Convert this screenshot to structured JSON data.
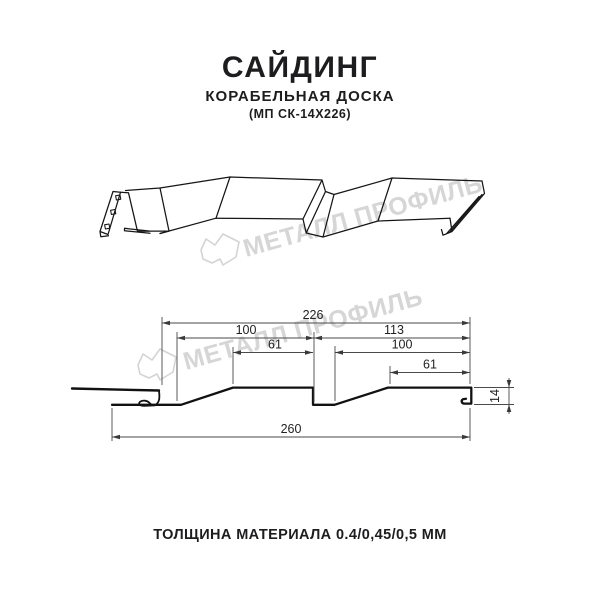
{
  "header": {
    "title": "САЙДИНГ",
    "subtitle": "КОРАБЕЛЬНАЯ ДОСКА",
    "model": "(МП СК-14Х226)"
  },
  "watermark": {
    "brand": "МЕТАЛЛ ПРОФИЛЬ",
    "color": "#d6d6d6"
  },
  "dimensions": {
    "overall_top": "226",
    "left_upper": "100",
    "right_upper": "113",
    "left_inner": "61",
    "right_inner": "100",
    "right_lower": "61",
    "overall_bottom": "260",
    "profile_height": "14"
  },
  "footer": {
    "thickness_label": "ТОЛЩИНА МАТЕРИАЛА 0.4/0,45/0,5 ММ"
  },
  "colors": {
    "profile_line": "#111111",
    "dimension_line": "#4a4a4a",
    "watermark": "#d6d6d6"
  }
}
